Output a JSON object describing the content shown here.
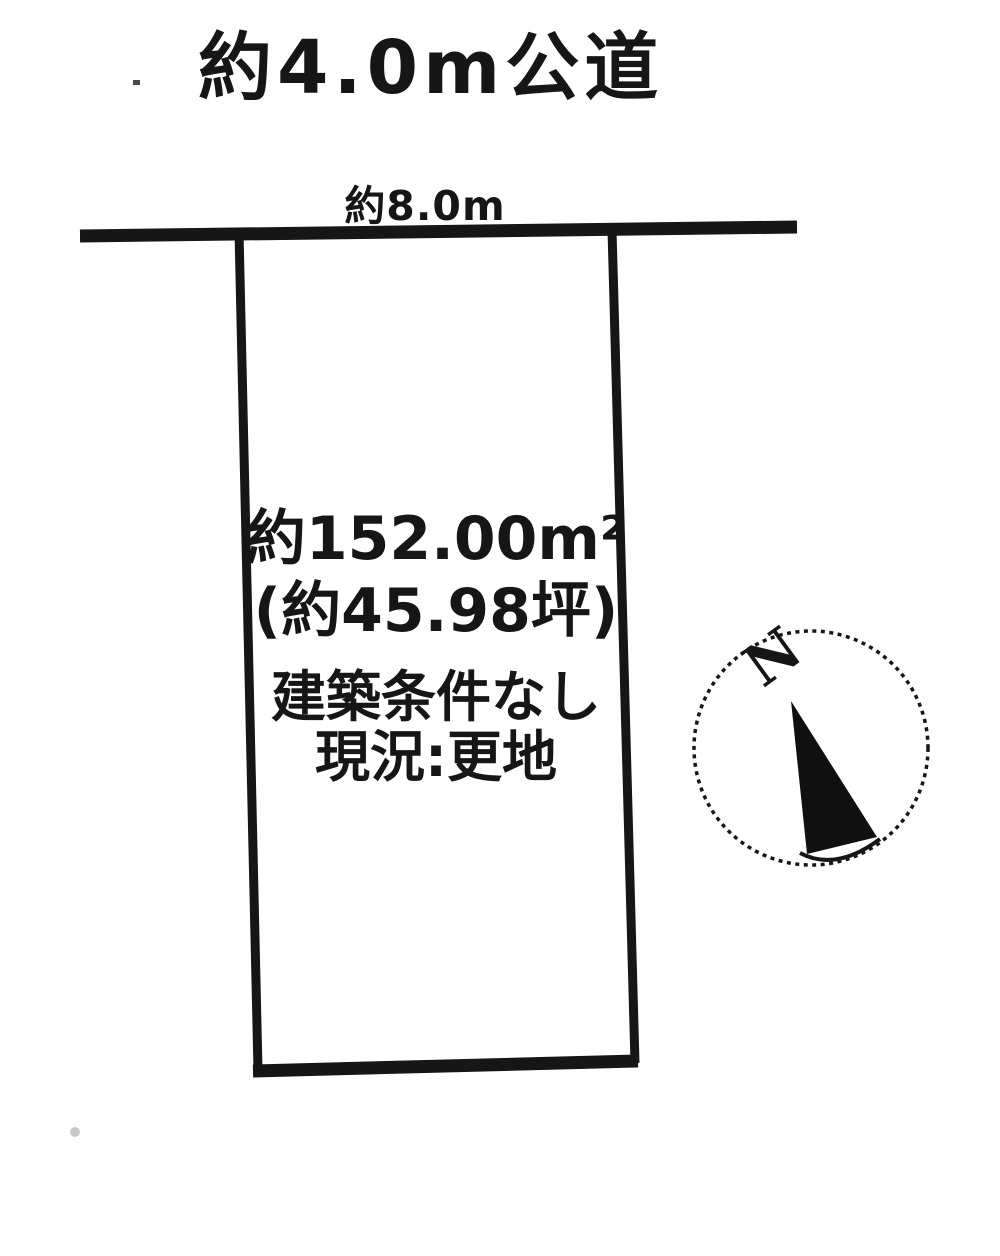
{
  "page": {
    "background": "#ffffff",
    "ink": "#161616"
  },
  "labels": {
    "road": "約4.0m公道",
    "frontage": "約8.0m"
  },
  "plot": {
    "area_m2": "約152.00m²",
    "area_tsubo": "(約45.98坪)",
    "building_condition": "建築条件なし",
    "current_status": "現況:更地"
  },
  "compass": {
    "north": "N"
  }
}
